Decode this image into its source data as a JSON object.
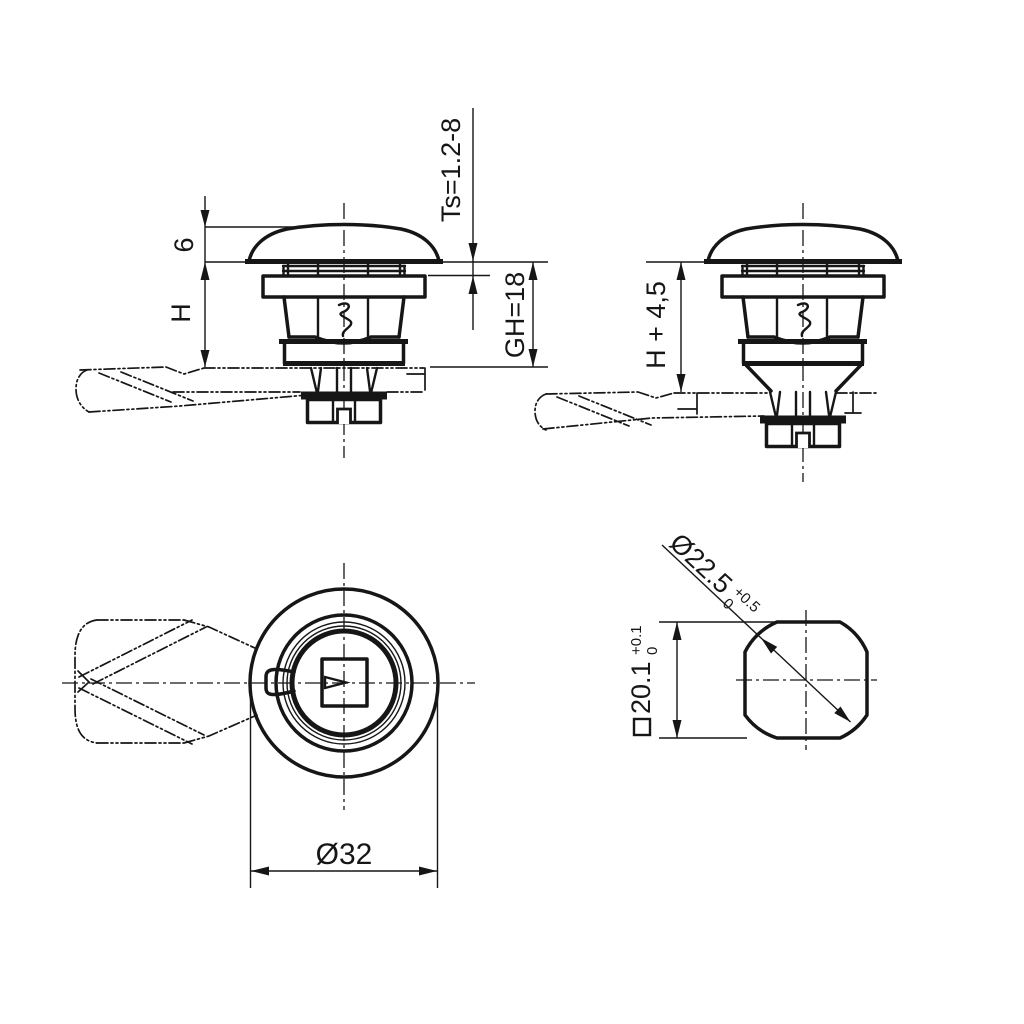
{
  "drawing": {
    "background": "#ffffff",
    "line_color": "#161616",
    "type": "technical drawing - quarter-turn compression latch",
    "views": {
      "side_installed": {
        "dims": {
          "cap_height": "6",
          "body_height": "H",
          "panel_range": "Ts=1.2-8",
          "grip_height": "GH=18"
        }
      },
      "side_released": {
        "dims": {
          "extended_height": "H + 4,5"
        }
      },
      "top": {
        "dims": {
          "outer_diameter": "Ø32"
        }
      },
      "cutout": {
        "dims": {
          "diagonal": {
            "value": "Ø22.5",
            "tol_upper": "+0.5",
            "tol_lower": "0"
          },
          "square": {
            "value": "20.1",
            "tol_upper": "+0.1",
            "tol_lower": "0"
          }
        }
      }
    }
  }
}
